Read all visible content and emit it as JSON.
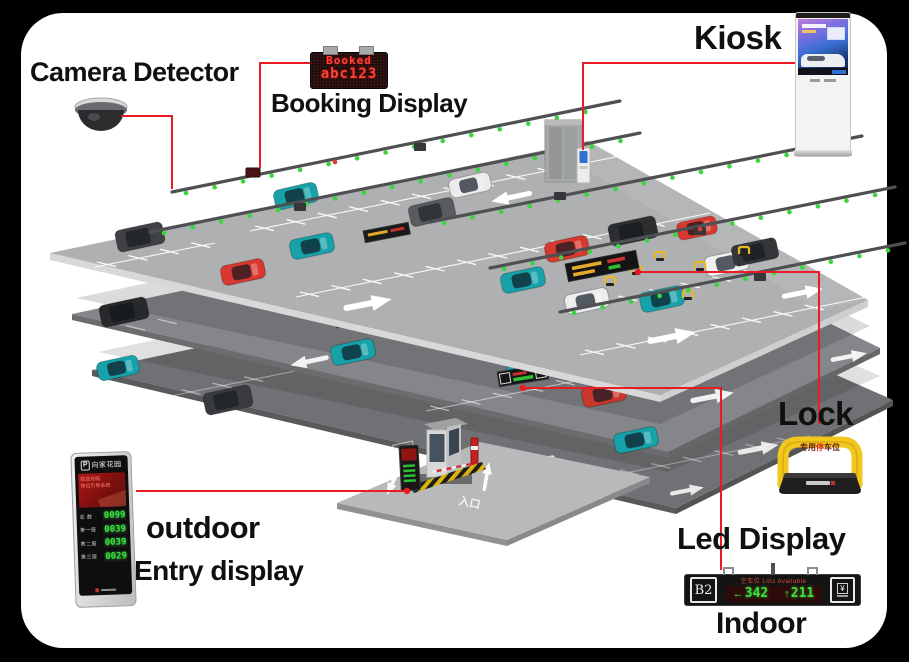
{
  "colors": {
    "connector_red": "#ea1b23",
    "rail_led_green": "#3bd63f",
    "booking_led_red": "#ff4438",
    "counter_green": "#3ae03e",
    "lock_yellow": "#f2c71d"
  },
  "labels": {
    "camera_detector": "Camera Detector",
    "booking_display": "Booking Display",
    "kiosk": "Kiosk",
    "lock": "Lock",
    "led_display": "Led Display",
    "indoor": "Indoor",
    "outdoor": "outdoor",
    "entry_display": "Entry display"
  },
  "booking_sign": {
    "line1": "Booked",
    "line2": "abc123"
  },
  "indoor_display": {
    "zone": "B2",
    "header": "空车位 Lots Available",
    "left_arrow": "←",
    "left_count": "342",
    "up_arrow": "↑",
    "right_count": "211",
    "icon_symbol": "¥"
  },
  "outdoor_display": {
    "badge": "P",
    "title": "向家花园",
    "screen_line1": "欢迎光临",
    "screen_line2": "车位引导系统",
    "rows": [
      {
        "label": "总 数",
        "value": "0099"
      },
      {
        "label": "第一层",
        "value": "0039"
      },
      {
        "label": "第二层",
        "value": "0039"
      },
      {
        "label": "第三层",
        "value": "0029"
      }
    ]
  },
  "lock_device": {
    "bar_left": "专用",
    "bar_mid": "停",
    "bar_right": "车位"
  },
  "scene": {
    "entrance_marking": "入口"
  }
}
